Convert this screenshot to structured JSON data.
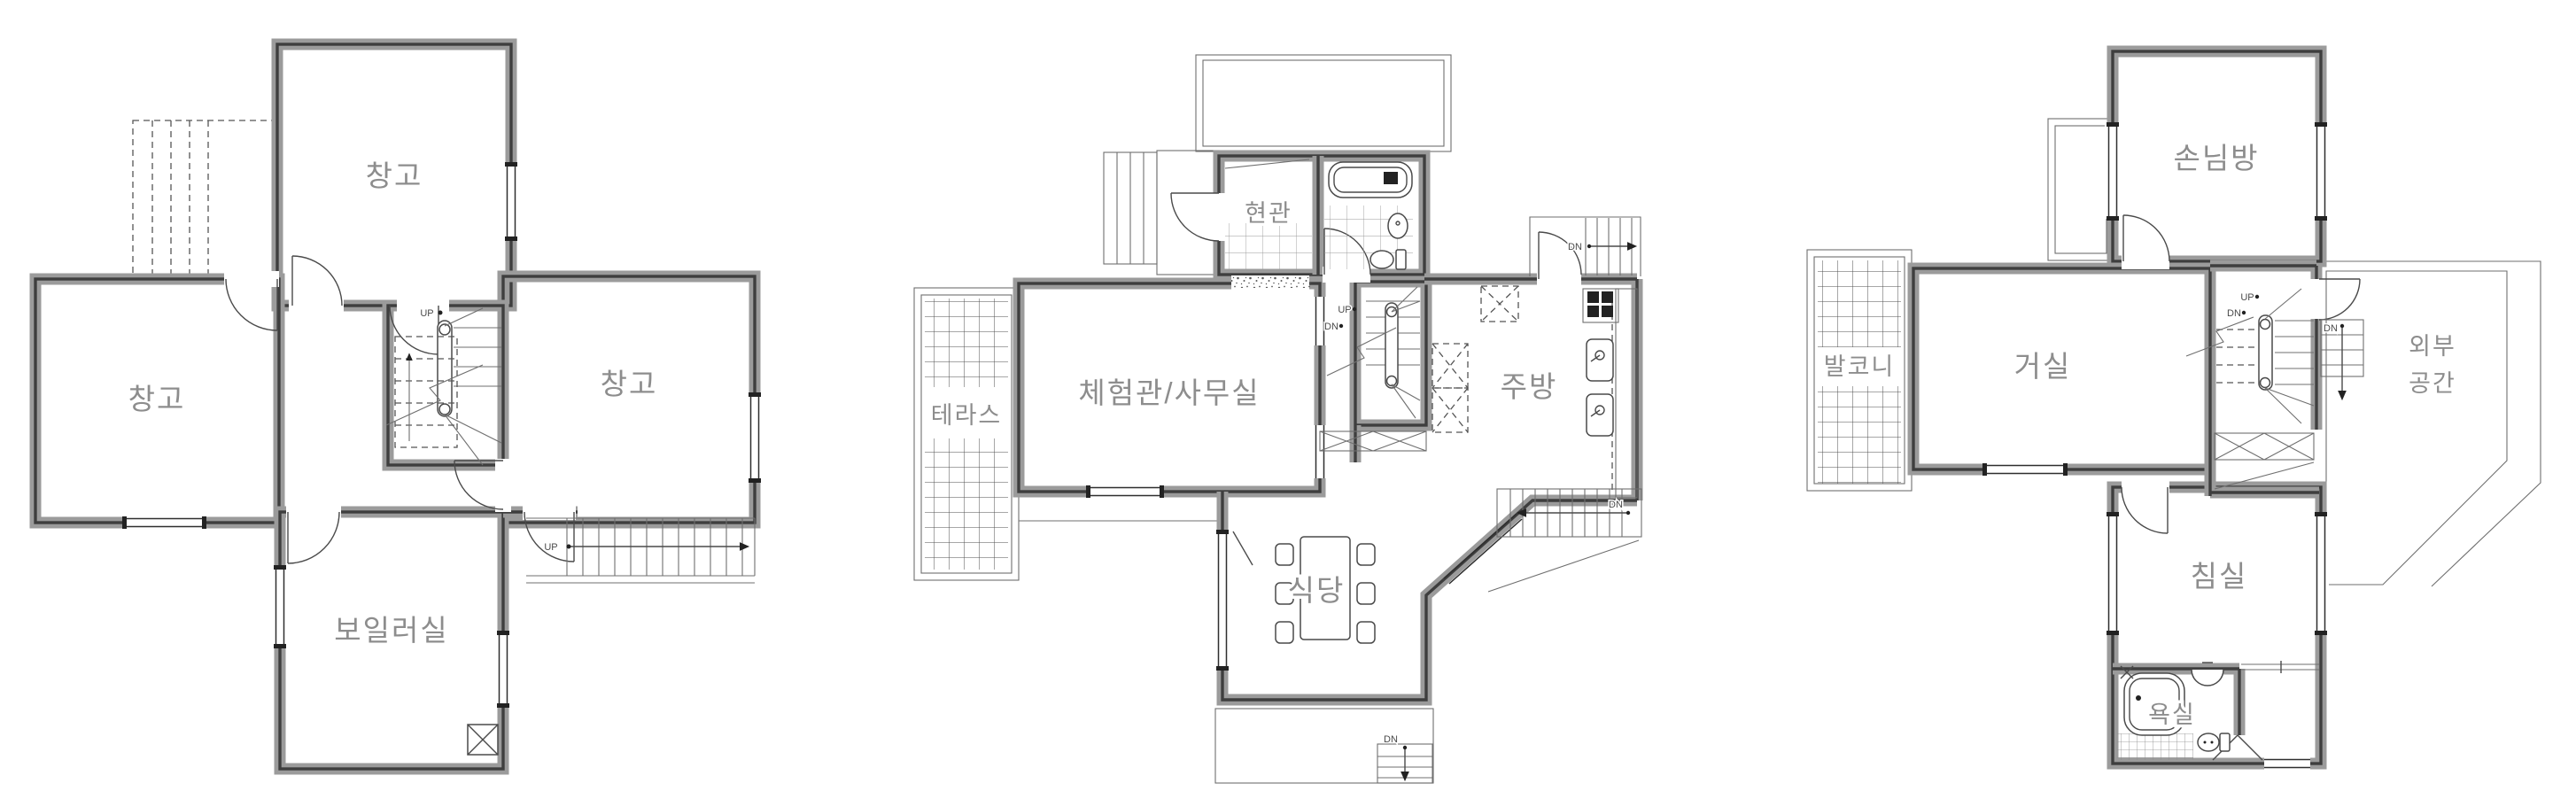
{
  "colors": {
    "background": "#ffffff",
    "wall_gray": "#9b9b9b",
    "wall_core": "#3e3e3e",
    "thin_line": "#4a4a4a",
    "label_gray": "#8d8d8d"
  },
  "plans": [
    {
      "rooms": [
        {
          "label": "창고"
        },
        {
          "label": "창고"
        },
        {
          "label": "창고"
        },
        {
          "label": "보일러실"
        }
      ],
      "stairs": {
        "core_up": "UP",
        "ext_up": "UP"
      }
    },
    {
      "rooms": [
        {
          "label": "현관"
        },
        {
          "label": "테라스"
        },
        {
          "label": "체험관/사무실"
        },
        {
          "label": "주방"
        },
        {
          "label": "식당"
        }
      ],
      "stairs": {
        "core_up": "UP",
        "core_dn": "DN",
        "top_right_dn": "DN",
        "right_dn": "DN",
        "bottom_dn": "DN"
      }
    },
    {
      "rooms": [
        {
          "label": "손님방"
        },
        {
          "label": "발코니"
        },
        {
          "label": "거실"
        },
        {
          "label": "외부 공간",
          "lines": [
            "외부",
            "공간"
          ]
        },
        {
          "label": "침실"
        },
        {
          "label": "욕실"
        }
      ],
      "stairs": {
        "core_up": "UP",
        "core_dn": "DN",
        "deck_dn": "DN"
      }
    }
  ]
}
